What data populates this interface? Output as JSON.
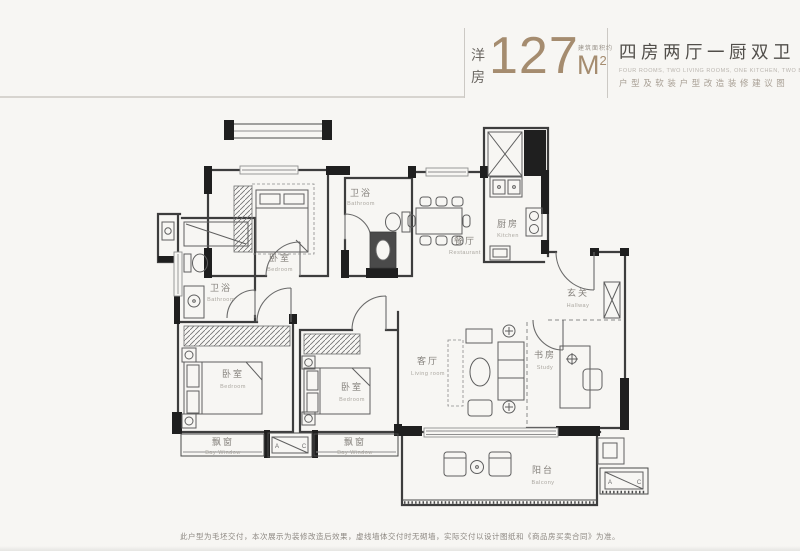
{
  "header": {
    "unit_type": "洋房",
    "area_value": "127",
    "area_note": "建筑面积约",
    "area_unit": "M",
    "area_sup": "2",
    "title": "四房两厅一厨双卫",
    "subtitle_en": "FOUR ROOMS, TWO LIVING ROOMS, ONE KITCHEN, TWO BATHROOMS",
    "subtitle_cn": "户型及软装户型改造装修建议图",
    "accent_color": "#a58c6f"
  },
  "plan": {
    "rooms": [
      {
        "cn": "卧室",
        "en": "Bedroom"
      },
      {
        "cn": "卫浴",
        "en": "Bathroom"
      },
      {
        "cn": "餐厅",
        "en": "Restaurant"
      },
      {
        "cn": "厨房",
        "en": "Kitchen"
      },
      {
        "cn": "玄关",
        "en": "Hallway"
      },
      {
        "cn": "卫浴",
        "en": "Bathroom"
      },
      {
        "cn": "卧室",
        "en": "Bedroom"
      },
      {
        "cn": "卧室",
        "en": "Bedroom"
      },
      {
        "cn": "客厅",
        "en": "Living room"
      },
      {
        "cn": "书房",
        "en": "Study"
      },
      {
        "cn": "阳台",
        "en": "Balcony"
      },
      {
        "cn": "飘窗",
        "en": "Bay Window"
      },
      {
        "cn": "飘窗",
        "en": "Bay Window"
      }
    ],
    "ac_a": "A",
    "ac_c": "C",
    "wall_color": "#1f1f1f"
  },
  "footer": {
    "disclaimer": "此户型为毛坯交付，本次展示为装修改造后效果，虚线墙体交付时无砌墙，实际交付以设计图纸和《商品房买卖合同》为准。"
  }
}
